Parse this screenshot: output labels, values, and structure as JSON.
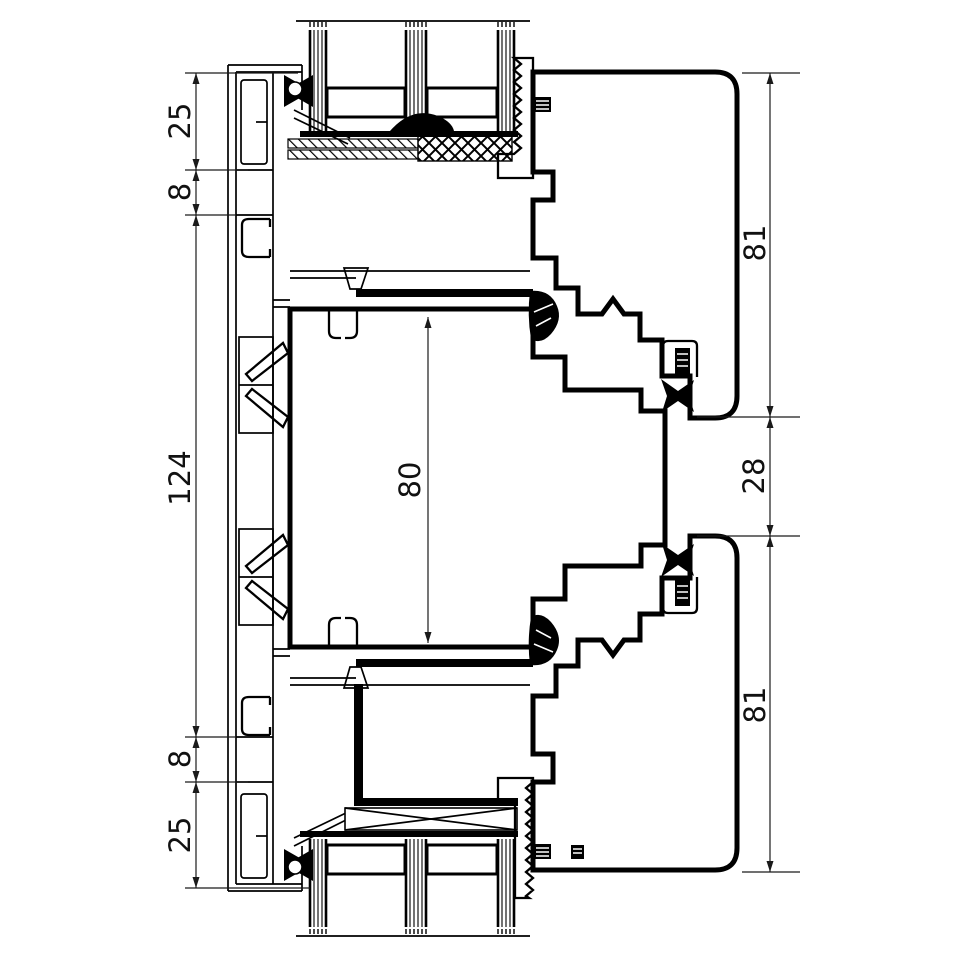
{
  "page": {
    "background": "#ffffff"
  },
  "drawing": {
    "type": "technical-profile-cross-section",
    "subject": "aluminium window/door frame and sash profiles with insulated glazing",
    "stroke_color": "#000000",
    "dimension_color": "#1a1a1a",
    "dimensions": {
      "left": [
        {
          "id": "left-top-25",
          "label": "25"
        },
        {
          "id": "left-top-8",
          "label": "8"
        },
        {
          "id": "left-middle-124",
          "label": "124"
        },
        {
          "id": "left-bottom-8",
          "label": "8"
        },
        {
          "id": "left-bottom-25",
          "label": "25"
        }
      ],
      "center": [
        {
          "id": "chamber-80",
          "label": "80"
        }
      ],
      "right": [
        {
          "id": "right-top-81",
          "label": "81"
        },
        {
          "id": "right-middle-28",
          "label": "28"
        },
        {
          "id": "right-bottom-81",
          "label": "81"
        }
      ]
    }
  }
}
